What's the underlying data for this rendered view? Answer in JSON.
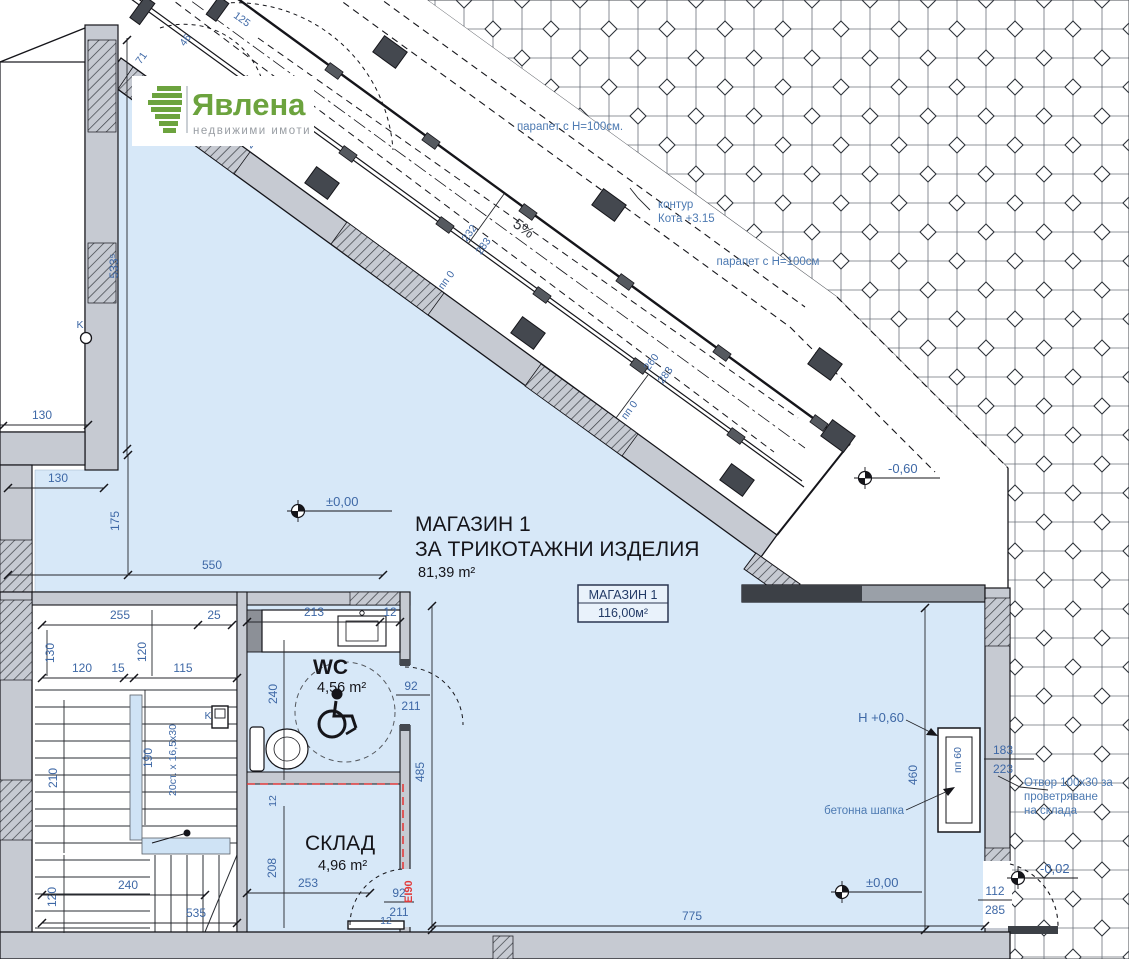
{
  "logo": {
    "name": "Явлена",
    "tagline": "недвижими имоти"
  },
  "rooms": {
    "shop": {
      "line1": "МАГАЗИН 1",
      "line2": "ЗА ТРИКОТАЖНИ ИЗДЕЛИЯ",
      "area": "81,39 m²"
    },
    "shop_box": {
      "title": "МАГАЗИН 1",
      "area": "116,00м²"
    },
    "wc": {
      "label": "WC",
      "area": "4,56 m²"
    },
    "storage": {
      "label": "СКЛАД",
      "area": "4,96 m²"
    }
  },
  "levels": {
    "l1": "±0,00",
    "l2": "-0,60",
    "l3": "±0,00",
    "l4": "-0,02",
    "l5": "Н +0,60"
  },
  "notes": {
    "parapet1": "парапет с Н=100см.",
    "parapet2": "парапет с Н=100см",
    "contour1": "контур",
    "contour2": "Кота +3.15",
    "slope": "5%",
    "pp0a": "пп 0",
    "pp0b": "пп 0",
    "pp60": "пп 60",
    "cap": "бетонна шапка",
    "vent1": "Отвор 100x30 за",
    "vent2": "проветряване",
    "vent3": "на склада",
    "fire": "EI90",
    "stairs_note": "20ст. x 16,5x30",
    "k": "K"
  },
  "dims": {
    "left_533": "533⁵",
    "left_130a": "130",
    "left_130b": "130",
    "left_175": "175",
    "left_550": "550",
    "top_125": "125",
    "top_71": "71",
    "top_46": "46",
    "top_280": "280",
    "ramp_232": "232",
    "ramp_283a": "283",
    "ramp_260": "260",
    "ramp_283b": "283",
    "st_255": "255",
    "st_25": "25",
    "st_130": "130",
    "st_120v": "120",
    "st_120": "120",
    "st_15": "15",
    "st_115": "115",
    "st_190": "190",
    "st_210": "210",
    "st_120b": "120",
    "st_240": "240",
    "st_535": "535",
    "wc_213": "213",
    "wc_12": "12",
    "wc_240": "240",
    "wc_92": "92",
    "wc_211": "211",
    "mid_485": "485",
    "sk_208": "208",
    "sk_12": "12",
    "sk_253": "253",
    "sk_92": "92",
    "sk_211": "211",
    "sk_12b": "12",
    "bt_775": "775",
    "rt_460": "460",
    "rt_183": "183",
    "rt_223": "223",
    "dr_112": "112",
    "dr_285": "285"
  },
  "colors": {
    "plan_blue": "#d7e8f8",
    "wall_gray": "#c6cad2",
    "wall_dark": "#44484f",
    "dim_blue": "#3e68a6",
    "fire_red": "#e23b3b",
    "logo_green": "#6ca33e",
    "tile_line": "#646a73"
  }
}
